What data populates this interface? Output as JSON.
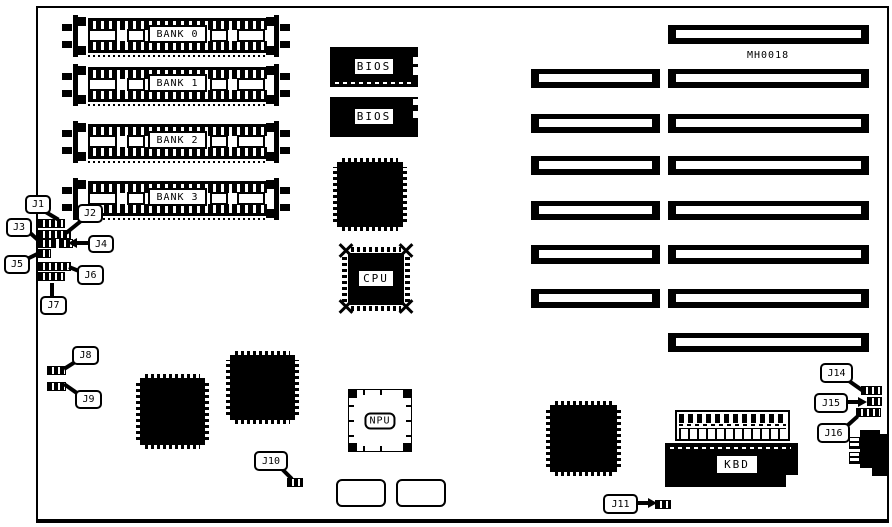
{
  "board": {
    "model": "MH0018",
    "memory_banks": [
      {
        "label": "BANK 0"
      },
      {
        "label": "BANK 1"
      },
      {
        "label": "BANK 2"
      },
      {
        "label": "BANK 3"
      }
    ],
    "chips": {
      "bios1": "BIOS",
      "bios2": "BIOS",
      "cpu": "CPU",
      "npu": "NPU",
      "kbd": "KBD"
    },
    "jumpers": [
      {
        "id": "J1"
      },
      {
        "id": "J2"
      },
      {
        "id": "J3"
      },
      {
        "id": "J4"
      },
      {
        "id": "J5"
      },
      {
        "id": "J6"
      },
      {
        "id": "J7"
      },
      {
        "id": "J8"
      },
      {
        "id": "J9"
      },
      {
        "id": "J10"
      },
      {
        "id": "J11"
      },
      {
        "id": "J14"
      },
      {
        "id": "J15"
      },
      {
        "id": "J16"
      }
    ],
    "expansion_slots": {
      "long_count": 8,
      "short_count": 6
    }
  },
  "colors": {
    "ink": "#000000",
    "paper": "#ffffff"
  }
}
